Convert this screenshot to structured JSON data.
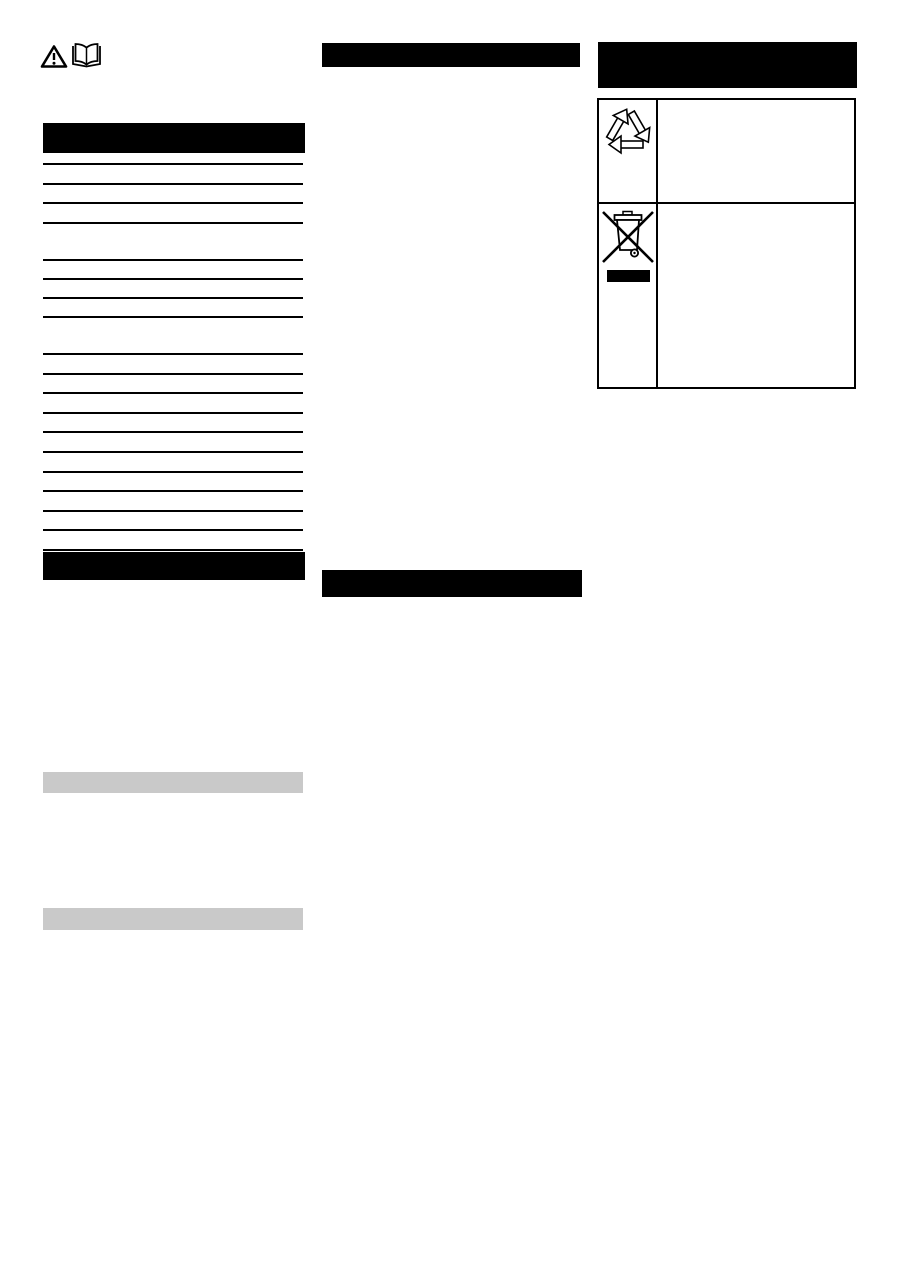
{
  "document": {
    "kind": "scanned manual page with redacted text",
    "background_color": "#ffffff",
    "ink_color": "#000000",
    "redaction_bar_color": "#000000",
    "subsection_bar_color": "#c9c9c9"
  },
  "top_icons": {
    "warning_triangle": "warning-triangle-icon",
    "open_book": "read-manual-icon"
  },
  "left_column": {
    "header_bar_1": {
      "style": "filled-black-redacted",
      "text": ""
    },
    "toc_groups": [
      {
        "entries": 4,
        "top": 163,
        "spacing": 19.7
      },
      {
        "entries": 4,
        "top": 259,
        "spacing": 19.0
      },
      {
        "entries": 11,
        "top": 353,
        "spacing": 19.6
      }
    ],
    "header_bar_2": {
      "style": "filled-black-redacted",
      "text": ""
    },
    "subsection_bars": [
      {
        "style": "filled-gray-redacted",
        "text": ""
      },
      {
        "style": "filled-gray-redacted",
        "text": ""
      }
    ]
  },
  "middle_column": {
    "header_bar_1": {
      "style": "filled-black-redacted",
      "text": ""
    },
    "header_bar_2": {
      "style": "filled-black-redacted",
      "text": ""
    }
  },
  "right_column": {
    "header_bar": {
      "style": "filled-black-redacted",
      "text": "",
      "lines": 2
    },
    "symbol_table": {
      "rows": [
        {
          "symbol": "recycling-arrows-icon",
          "description_text": ""
        },
        {
          "symbol": "weee-crossed-out-bin-icon",
          "extra": "redacted-label-bar",
          "description_text": ""
        }
      ]
    }
  }
}
